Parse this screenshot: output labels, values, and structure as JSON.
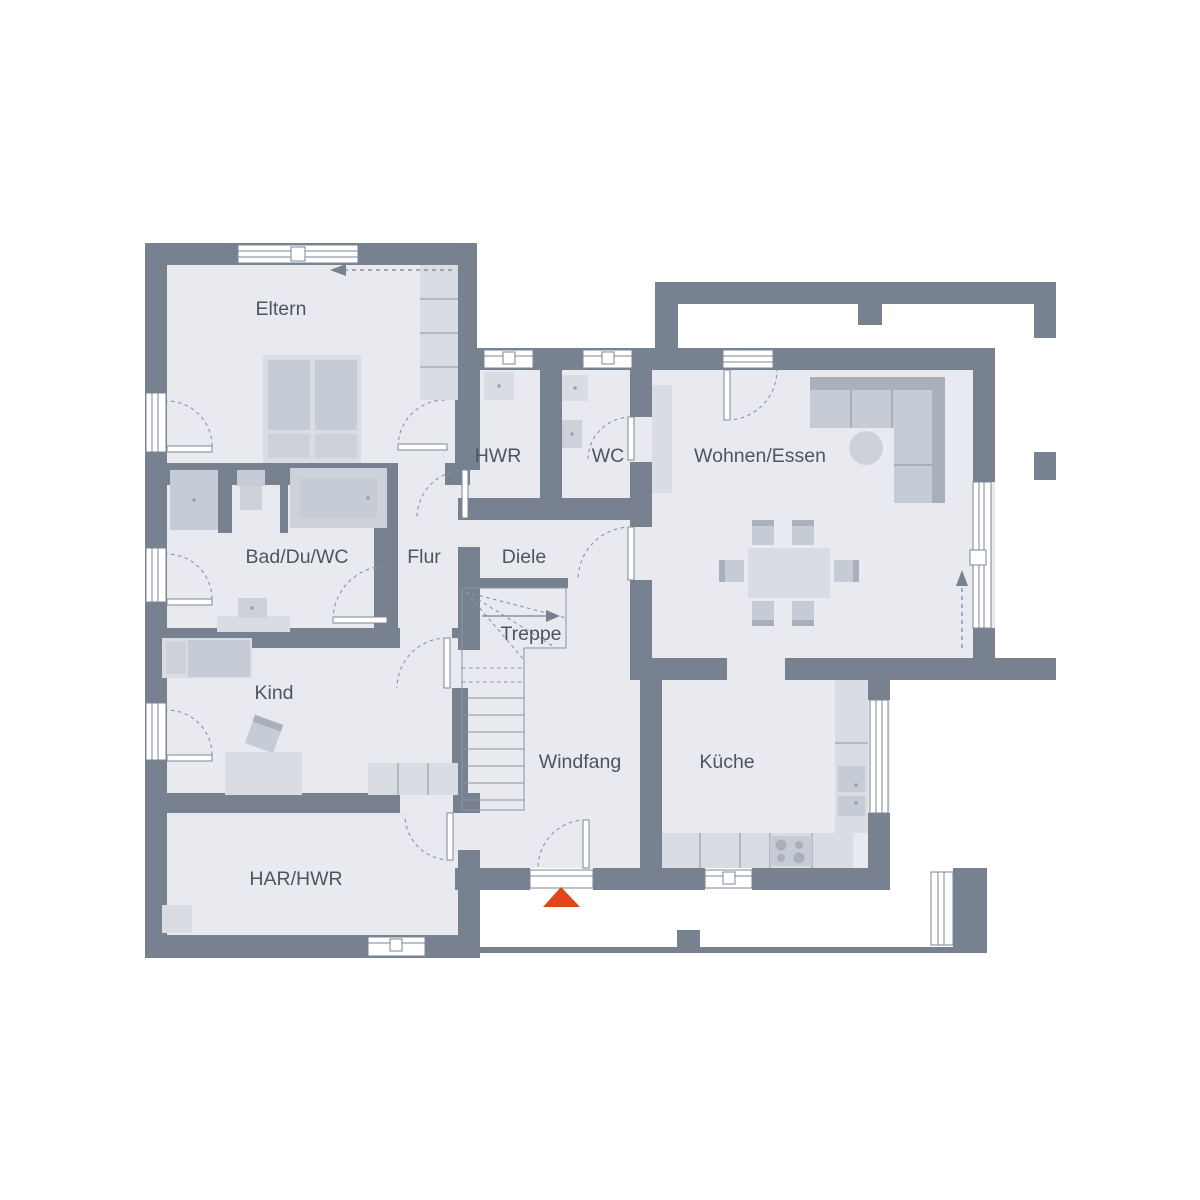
{
  "plan": {
    "type": "floor-plan",
    "floor": "ground-floor"
  },
  "palette": {
    "wall": "#78818f",
    "floor": "#e8eaef",
    "furniture_light": "#d9dce2",
    "furniture_mid": "#c6ccd5",
    "furniture_dark": "#a9afbb",
    "line": "#8a93a0",
    "text": "#4c5560",
    "accent": "#e0451c",
    "background": "#ffffff"
  },
  "rooms": [
    {
      "id": "eltern",
      "label": "Eltern"
    },
    {
      "id": "hwr",
      "label": "HWR"
    },
    {
      "id": "wc",
      "label": "WC"
    },
    {
      "id": "wohnen-essen",
      "label": "Wohnen/Essen"
    },
    {
      "id": "bad-du-wc",
      "label": "Bad/Du/WC"
    },
    {
      "id": "flur",
      "label": "Flur"
    },
    {
      "id": "diele",
      "label": "Diele"
    },
    {
      "id": "treppe",
      "label": "Treppe"
    },
    {
      "id": "kind",
      "label": "Kind"
    },
    {
      "id": "windfang",
      "label": "Windfang"
    },
    {
      "id": "kueche",
      "label": "Küche"
    },
    {
      "id": "har-hwr",
      "label": "HAR/HWR"
    }
  ],
  "markers": {
    "entrance": {
      "icon": "entrance-triangle",
      "color": "#e0451c"
    },
    "stair_direction": {
      "icon": "arrow-right"
    },
    "sliding_window_top": {
      "icon": "arrow-left-dashed"
    },
    "terrace_door_east": {
      "icon": "arrow-up-dashed"
    }
  }
}
